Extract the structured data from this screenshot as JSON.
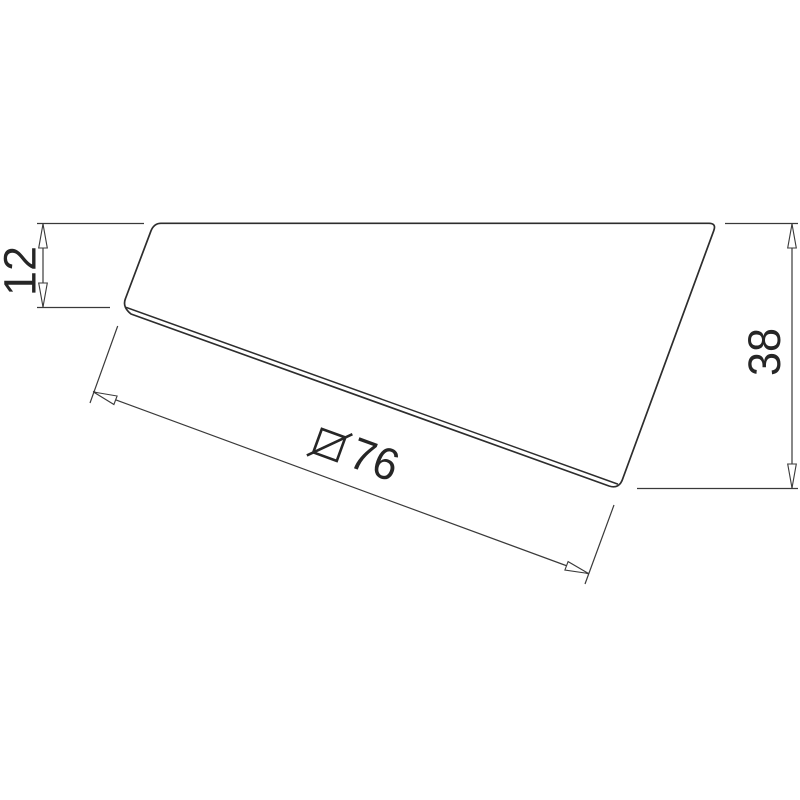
{
  "drawing": {
    "type": "technical-dimension-drawing",
    "background_color": "#ffffff",
    "outline_color": "#2d2d2d",
    "dimension_color": "#3a3a3a",
    "text_color": "#262626",
    "dimensions": {
      "left_height": {
        "value": "12"
      },
      "right_height": {
        "value": "38"
      },
      "diagonal_width": {
        "value": "76",
        "symbol": "square-with-diagonal"
      }
    }
  }
}
